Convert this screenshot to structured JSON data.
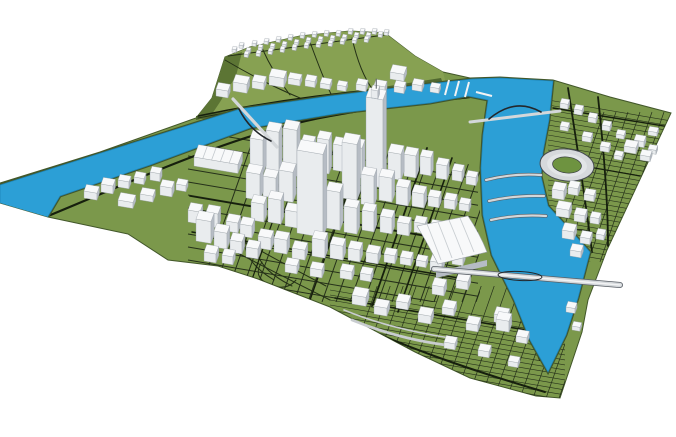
{
  "colors": {
    "background": "#ffffff",
    "terrain": "#7b984b",
    "hillLight": "#87a152",
    "hillDark": "#5c7534",
    "bandDark": "#50682f",
    "bank": "#42572a",
    "water": "#2c9fd6",
    "waterEdge": "#1d82b4",
    "roadMajor": "#161f0d",
    "roadMinor": "#243016",
    "hatch": "#25301a",
    "rampGray": "#c9cdd0",
    "buildingTop": "#f8f9fa",
    "buildingLit": "#e9ecee",
    "buildingShade": "#b6bcc4",
    "buildingEdge": "#9aa1a8",
    "stadiumStands": "#d6d9dc",
    "stadiumTier": "#e2e5e7",
    "stadiumField": "#6e9340",
    "bridgeDeck": "#d3d7da",
    "bridgeLight": "#f2f3f4",
    "bridgeDark": "#595f66",
    "archDark": "#23272b"
  },
  "houses": [
    [
      232,
      52
    ],
    [
      239,
      48
    ],
    [
      246,
      53
    ],
    [
      252,
      46
    ],
    [
      258,
      50
    ],
    [
      264,
      44
    ],
    [
      270,
      49
    ],
    [
      276,
      42
    ],
    [
      282,
      47
    ],
    [
      288,
      40
    ],
    [
      294,
      45
    ],
    [
      300,
      38
    ],
    [
      306,
      43
    ],
    [
      312,
      37
    ],
    [
      318,
      42
    ],
    [
      324,
      36
    ],
    [
      330,
      41
    ],
    [
      336,
      36
    ],
    [
      342,
      40
    ],
    [
      348,
      34
    ],
    [
      354,
      38
    ],
    [
      360,
      34
    ],
    [
      366,
      38
    ],
    [
      372,
      34
    ],
    [
      378,
      37
    ],
    [
      384,
      35
    ],
    [
      268,
      54
    ],
    [
      280,
      52
    ],
    [
      292,
      50
    ],
    [
      304,
      48
    ],
    [
      316,
      47
    ],
    [
      328,
      46
    ],
    [
      340,
      44
    ],
    [
      352,
      43
    ],
    [
      364,
      42
    ],
    [
      244,
      57
    ],
    [
      256,
      56
    ]
  ],
  "buildings": [
    [
      216,
      96,
      12,
      7,
      7
    ],
    [
      233,
      91,
      14,
      8,
      9
    ],
    [
      252,
      88,
      12,
      7,
      7
    ],
    [
      269,
      85,
      15,
      8,
      9
    ],
    [
      288,
      84,
      12,
      6,
      6
    ],
    [
      305,
      86,
      10,
      6,
      6
    ],
    [
      320,
      88,
      10,
      6,
      5
    ],
    [
      337,
      90,
      9,
      5,
      5
    ],
    [
      356,
      90,
      10,
      6,
      6
    ],
    [
      374,
      92,
      11,
      6,
      7
    ],
    [
      394,
      92,
      10,
      6,
      6
    ],
    [
      412,
      90,
      10,
      6,
      6
    ],
    [
      390,
      79,
      14,
      8,
      7
    ],
    [
      430,
      92,
      9,
      5,
      5
    ],
    [
      560,
      108,
      8,
      5,
      5
    ],
    [
      574,
      114,
      8,
      5,
      5
    ],
    [
      588,
      122,
      8,
      5,
      5
    ],
    [
      602,
      130,
      8,
      5,
      5
    ],
    [
      616,
      138,
      8,
      5,
      4
    ],
    [
      634,
      146,
      10,
      6,
      6
    ],
    [
      648,
      153,
      8,
      5,
      4
    ],
    [
      560,
      130,
      8,
      5,
      4
    ],
    [
      582,
      141,
      9,
      5,
      5
    ],
    [
      600,
      151,
      9,
      5,
      5
    ],
    [
      614,
      159,
      8,
      5,
      4
    ],
    [
      624,
      152,
      12,
      7,
      6
    ],
    [
      640,
      160,
      10,
      6,
      5
    ],
    [
      648,
      135,
      9,
      5,
      4
    ],
    [
      552,
      198,
      12,
      8,
      9
    ],
    [
      568,
      194,
      10,
      7,
      7
    ],
    [
      584,
      200,
      10,
      6,
      6
    ],
    [
      556,
      216,
      13,
      8,
      8
    ],
    [
      574,
      221,
      11,
      7,
      7
    ],
    [
      590,
      223,
      9,
      6,
      6
    ],
    [
      562,
      238,
      12,
      8,
      8
    ],
    [
      580,
      243,
      10,
      7,
      6
    ],
    [
      596,
      239,
      8,
      6,
      5
    ],
    [
      570,
      256,
      11,
      7,
      6
    ],
    [
      84,
      198,
      13,
      7,
      7
    ],
    [
      101,
      192,
      12,
      7,
      8
    ],
    [
      118,
      187,
      11,
      6,
      7
    ],
    [
      134,
      183,
      10,
      6,
      6
    ],
    [
      150,
      180,
      10,
      6,
      8
    ],
    [
      118,
      206,
      15,
      8,
      6
    ],
    [
      140,
      200,
      13,
      7,
      6
    ],
    [
      160,
      195,
      12,
      7,
      9
    ],
    [
      176,
      190,
      10,
      6,
      6
    ],
    [
      194,
      166,
      44,
      13,
      9,
      "saw"
    ],
    [
      188,
      222,
      12,
      8,
      12
    ],
    [
      206,
      226,
      12,
      8,
      14
    ],
    [
      226,
      231,
      12,
      8,
      10
    ],
    [
      240,
      236,
      12,
      8,
      12
    ],
    [
      196,
      241,
      15,
      9,
      22
    ],
    [
      214,
      247,
      13,
      8,
      16
    ],
    [
      230,
      252,
      12,
      8,
      12
    ],
    [
      204,
      261,
      12,
      8,
      9
    ],
    [
      222,
      263,
      11,
      7,
      8
    ],
    [
      246,
      257,
      12,
      8,
      10
    ],
    [
      250,
      172,
      13,
      9,
      34
    ],
    [
      266,
      170,
      13,
      9,
      40
    ],
    [
      283,
      174,
      14,
      9,
      46
    ],
    [
      301,
      170,
      12,
      8,
      28
    ],
    [
      317,
      172,
      12,
      8,
      34
    ],
    [
      333,
      170,
      12,
      8,
      26
    ],
    [
      349,
      176,
      13,
      9,
      30
    ],
    [
      366,
      185,
      17,
      10,
      88,
      "spire"
    ],
    [
      388,
      178,
      13,
      9,
      26
    ],
    [
      404,
      176,
      12,
      8,
      22
    ],
    [
      420,
      174,
      11,
      7,
      18
    ],
    [
      436,
      178,
      11,
      7,
      14
    ],
    [
      452,
      180,
      10,
      7,
      10
    ],
    [
      466,
      184,
      10,
      6,
      8
    ],
    [
      246,
      198,
      14,
      9,
      26
    ],
    [
      263,
      196,
      13,
      8,
      20
    ],
    [
      279,
      200,
      14,
      9,
      30
    ],
    [
      297,
      202,
      13,
      8,
      22
    ],
    [
      342,
      198,
      15,
      10,
      56
    ],
    [
      361,
      204,
      13,
      8,
      30
    ],
    [
      379,
      200,
      13,
      8,
      24
    ],
    [
      396,
      204,
      12,
      8,
      18
    ],
    [
      412,
      206,
      12,
      8,
      14
    ],
    [
      428,
      206,
      11,
      7,
      10
    ],
    [
      444,
      208,
      11,
      7,
      9
    ],
    [
      459,
      210,
      10,
      6,
      7
    ],
    [
      251,
      220,
      13,
      8,
      18
    ],
    [
      268,
      222,
      13,
      8,
      24
    ],
    [
      285,
      226,
      13,
      8,
      16
    ],
    [
      297,
      233,
      26,
      11,
      83
    ],
    [
      326,
      228,
      14,
      9,
      38
    ],
    [
      344,
      232,
      13,
      8,
      26
    ],
    [
      362,
      230,
      12,
      8,
      20
    ],
    [
      380,
      232,
      12,
      8,
      16
    ],
    [
      397,
      234,
      12,
      7,
      12
    ],
    [
      414,
      232,
      11,
      7,
      10
    ],
    [
      430,
      234,
      11,
      7,
      8
    ],
    [
      447,
      236,
      10,
      6,
      6
    ],
    [
      258,
      248,
      13,
      8,
      12
    ],
    [
      274,
      252,
      13,
      8,
      14
    ],
    [
      292,
      258,
      13,
      8,
      10
    ],
    [
      312,
      256,
      13,
      8,
      18
    ],
    [
      330,
      258,
      13,
      8,
      14
    ],
    [
      348,
      260,
      12,
      8,
      12
    ],
    [
      366,
      262,
      12,
      8,
      10
    ],
    [
      384,
      262,
      11,
      7,
      8
    ],
    [
      400,
      264,
      11,
      7,
      7
    ],
    [
      416,
      266,
      10,
      6,
      6
    ],
    [
      285,
      272,
      12,
      7,
      8
    ],
    [
      310,
      276,
      12,
      7,
      8
    ],
    [
      340,
      278,
      12,
      7,
      8
    ],
    [
      360,
      280,
      11,
      7,
      7
    ],
    [
      430,
      270,
      12,
      8,
      9
    ],
    [
      452,
      264,
      11,
      7,
      8
    ],
    [
      352,
      304,
      14,
      9,
      9
    ],
    [
      374,
      314,
      13,
      8,
      8
    ],
    [
      396,
      308,
      12,
      8,
      7
    ],
    [
      418,
      322,
      13,
      8,
      8
    ],
    [
      442,
      314,
      12,
      8,
      7
    ],
    [
      466,
      330,
      12,
      8,
      7
    ],
    [
      494,
      322,
      13,
      8,
      8
    ],
    [
      516,
      342,
      11,
      7,
      6
    ],
    [
      444,
      348,
      11,
      7,
      6
    ],
    [
      478,
      356,
      11,
      7,
      6
    ],
    [
      508,
      366,
      10,
      6,
      5
    ],
    [
      432,
      294,
      12,
      8,
      9
    ],
    [
      456,
      288,
      12,
      8,
      8
    ],
    [
      496,
      330,
      13,
      8,
      11
    ],
    [
      566,
      312,
      9,
      6,
      5
    ],
    [
      572,
      330,
      8,
      5,
      4
    ]
  ],
  "grids": [
    {
      "name": "downtown",
      "clip": [
        [
          185,
          120
        ],
        [
          480,
          166
        ],
        [
          480,
          302
        ],
        [
          185,
          302
        ]
      ],
      "a": {
        "x0": 188,
        "x1": 478,
        "yStart": 130,
        "yEnd": 278,
        "step": 13,
        "slope": 0.17,
        "w": 1.0
      },
      "b": {
        "y0": 302,
        "xStart": 196,
        "xEnd": 478,
        "step": 14,
        "dx": 66,
        "dy": -188,
        "w": 1.0
      }
    },
    {
      "name": "south",
      "clip": [
        [
          328,
          286
        ],
        [
          565,
          286
        ],
        [
          565,
          402
        ],
        [
          328,
          402
        ]
      ],
      "a": {
        "x0": 330,
        "x1": 565,
        "yStart": 290,
        "yEnd": 400,
        "step": 5,
        "slope": 0.17,
        "w": 0.6
      },
      "b": {
        "y0": 404,
        "xStart": 336,
        "xEnd": 558,
        "step": 13,
        "dx": 44,
        "dy": -126,
        "w": 0.7
      }
    },
    {
      "name": "northeast",
      "clip": [
        [
          546,
          94
        ],
        [
          676,
          108
        ],
        [
          676,
          230
        ],
        [
          600,
          262
        ],
        [
          546,
          262
        ]
      ],
      "a": {
        "x0": 548,
        "x1": 678,
        "yStart": 100,
        "yEnd": 258,
        "step": 5,
        "slope": 0.17,
        "w": 0.6
      },
      "b": {
        "y0": 262,
        "xStart": 552,
        "xEnd": 670,
        "step": 12,
        "dx": 52,
        "dy": -150,
        "w": 0.7
      }
    }
  ]
}
